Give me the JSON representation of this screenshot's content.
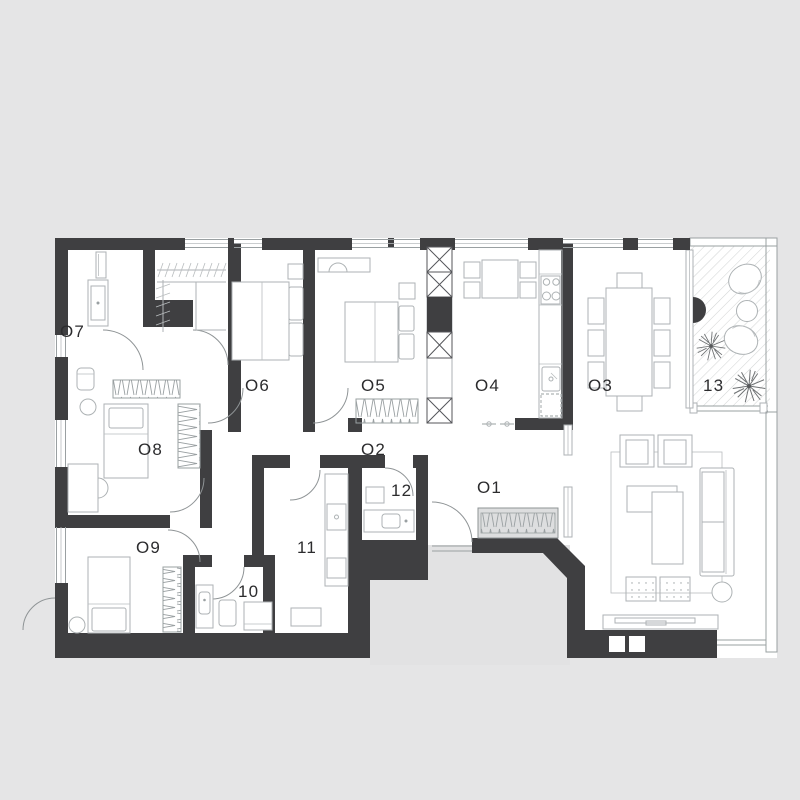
{
  "plan_type": "apartment-floor-plan",
  "labels": {
    "o1": "O1",
    "o2": "O2",
    "o3": "O3",
    "o4": "O4",
    "o5": "O5",
    "o6": "O6",
    "o7": "O7",
    "o8": "O8",
    "o9": "O9",
    "r10": "10",
    "r11": "11",
    "r12": "12",
    "r13": "13"
  },
  "rooms": [
    {
      "id": "O1",
      "kind": "entrance-hall"
    },
    {
      "id": "O2",
      "kind": "corridor"
    },
    {
      "id": "O3",
      "kind": "dining-room"
    },
    {
      "id": "O4",
      "kind": "kitchen"
    },
    {
      "id": "O5",
      "kind": "bedroom"
    },
    {
      "id": "O6",
      "kind": "bedroom"
    },
    {
      "id": "O7",
      "kind": "bathroom"
    },
    {
      "id": "O8",
      "kind": "bedroom"
    },
    {
      "id": "O9",
      "kind": "bedroom"
    },
    {
      "id": "10",
      "kind": "bathroom"
    },
    {
      "id": "11",
      "kind": "utility-room"
    },
    {
      "id": "12",
      "kind": "toilet"
    },
    {
      "id": "13",
      "kind": "balcony"
    }
  ],
  "colors": {
    "background": "#e5e5e6",
    "floor": "#ffffff",
    "wall": "#3f3f41",
    "furniture_line": "#adb2b4",
    "label_text": "#2c2c2e",
    "outside": "#e2e2e3"
  }
}
